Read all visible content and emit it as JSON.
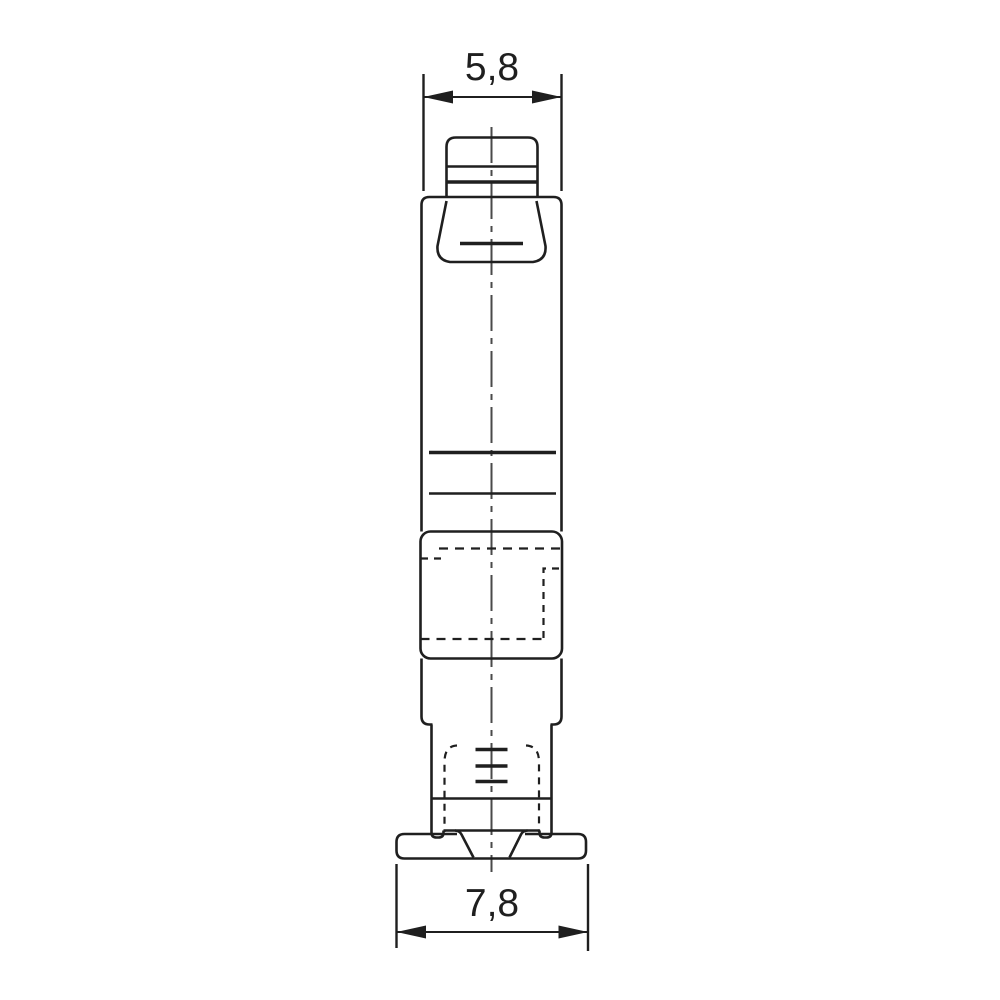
{
  "colors": {
    "background": "#ffffff",
    "outline": "#1f1f1f",
    "centerline": "#4a4a4a"
  },
  "dimensions": {
    "top_width": "5,8",
    "bottom_width": "7,8"
  }
}
